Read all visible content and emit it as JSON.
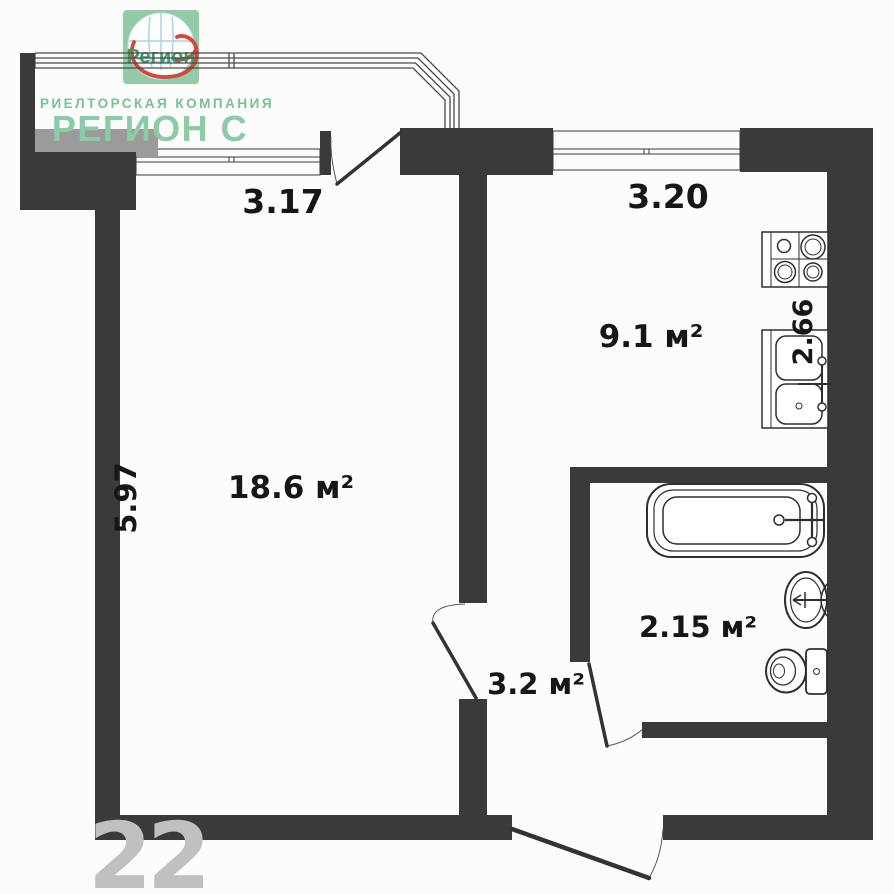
{
  "brand": {
    "logo_text": "Регион",
    "tagline": "РИЕЛТОРСКАЯ КОМПАНИЯ",
    "name": "РЕГИОН С",
    "colors": {
      "green": "#8bcba6",
      "logo_square": "#93cba8",
      "swoosh_red": "#d5473e",
      "globe_blue": "#a8d2e8"
    }
  },
  "plan": {
    "rooms": [
      {
        "id": "living-room",
        "area": "18.6 м²"
      },
      {
        "id": "kitchen",
        "area": "9.1 м²"
      },
      {
        "id": "bathroom",
        "area": "2.15 м²"
      },
      {
        "id": "hallway",
        "area": "3.2 м²"
      }
    ],
    "dimensions": [
      {
        "id": "living-room-width",
        "value": "3.17"
      },
      {
        "id": "kitchen-width",
        "value": "3.20"
      },
      {
        "id": "living-room-depth",
        "value": "5.97"
      },
      {
        "id": "kitchen-depth",
        "value": "2.66"
      }
    ],
    "fixtures": [
      "stove-icon",
      "kitchen-sink-icon",
      "bathtub-icon",
      "washbasin-icon",
      "toilet-icon"
    ],
    "colors": {
      "wall": "#3b3a39",
      "sill": "#9b9b9b",
      "background": "#fcfcfa"
    }
  },
  "watermark": {
    "text": "22"
  }
}
